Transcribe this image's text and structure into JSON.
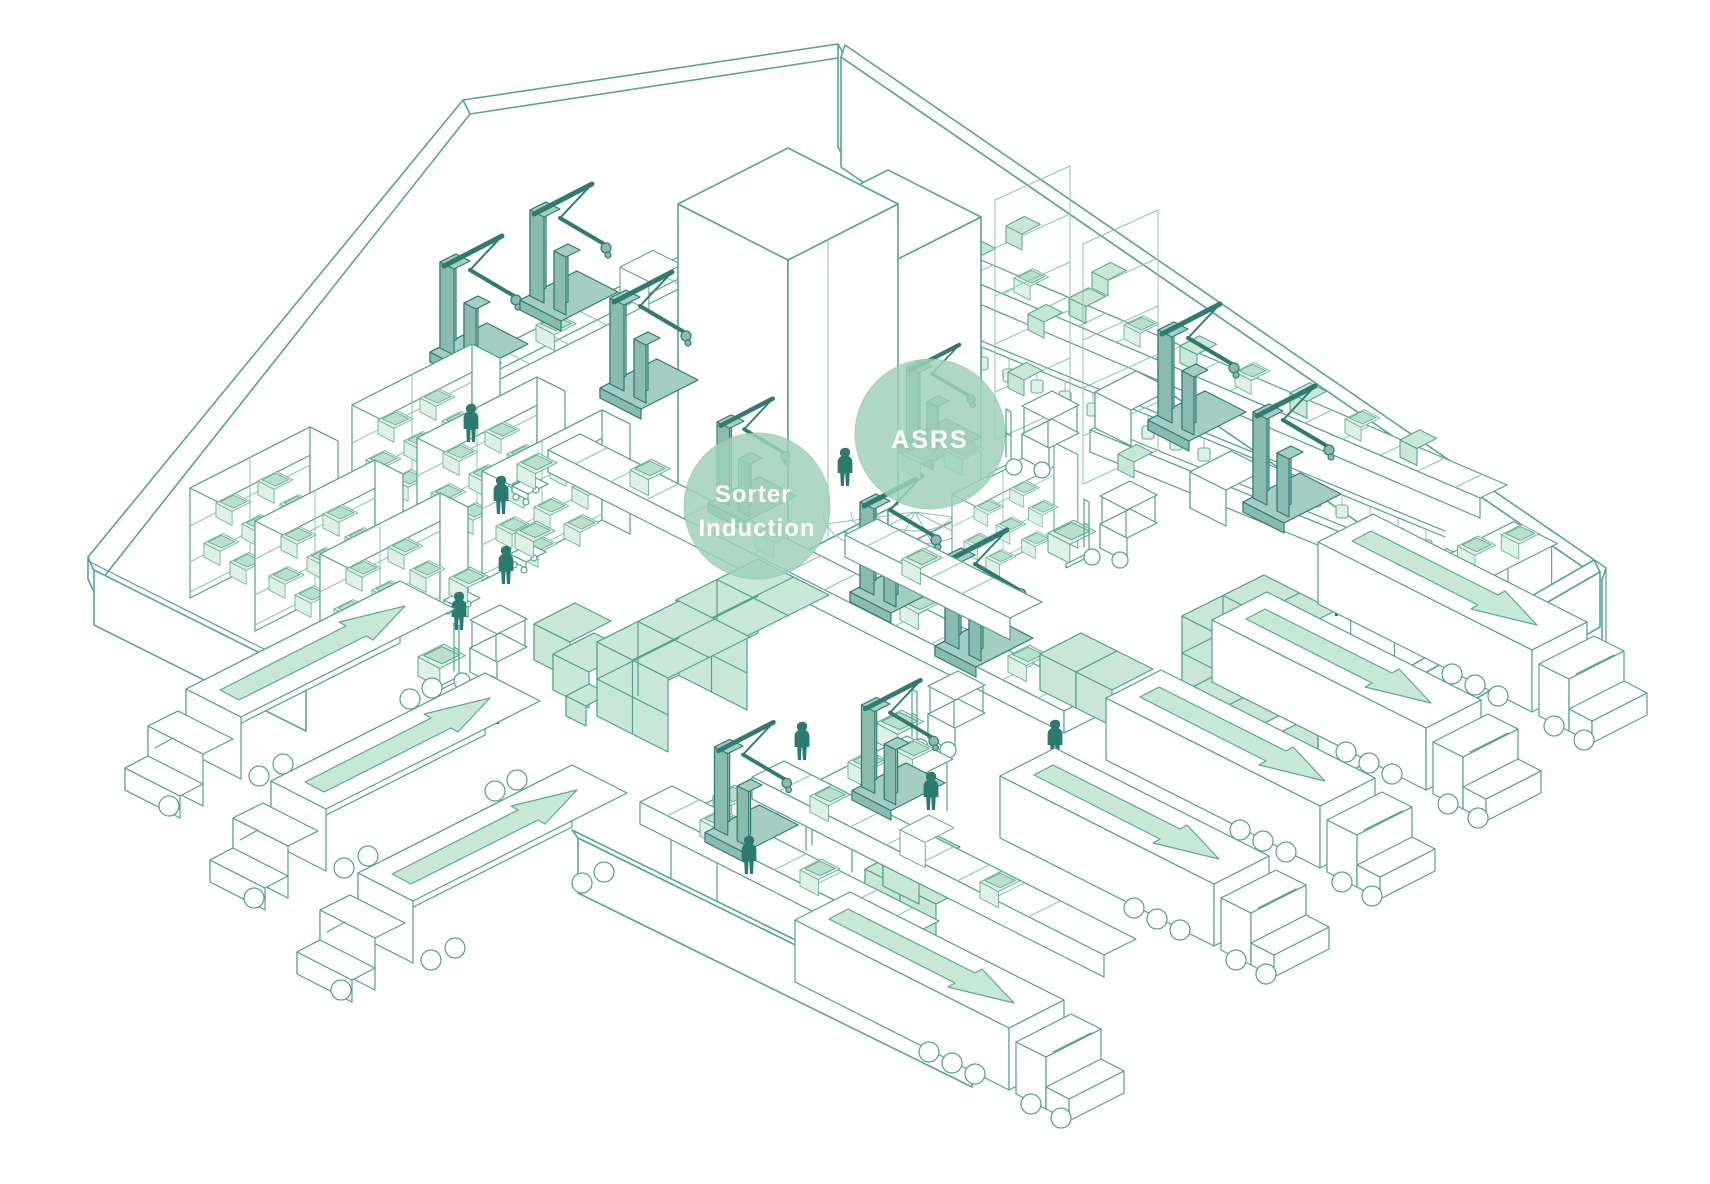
{
  "annotations": [
    {
      "id": "sorter-induction",
      "lines": [
        "Sorter",
        "Induction"
      ]
    },
    {
      "id": "asrs",
      "lines": [
        "ASRS"
      ]
    }
  ],
  "palette": {
    "background": "#ffffff",
    "wall_line": "#54a794",
    "structure_line": "#4fa38e",
    "light_line": "#8cc5b4",
    "box_green": "#c8e7d6",
    "box_green_light": "#dff1e7",
    "bin_inner": "#b9e0cd",
    "machine_fill": "#a5cec3",
    "machine_fill_dark": "#8abbaf",
    "figure_dark": "#2b7a70",
    "arrow_green": "#c6e8d5",
    "highlight_circle": "#9fd0ba",
    "label_text": "#ffffff"
  },
  "inventory": {
    "inbound_trucks": 3,
    "outbound_trucks": 5,
    "workers": 12,
    "robot_arms": 11,
    "forklifts": 4,
    "storage_racks": 7,
    "high_bay_columns": 2,
    "conveyors": 6,
    "asrs_towers": 2
  }
}
